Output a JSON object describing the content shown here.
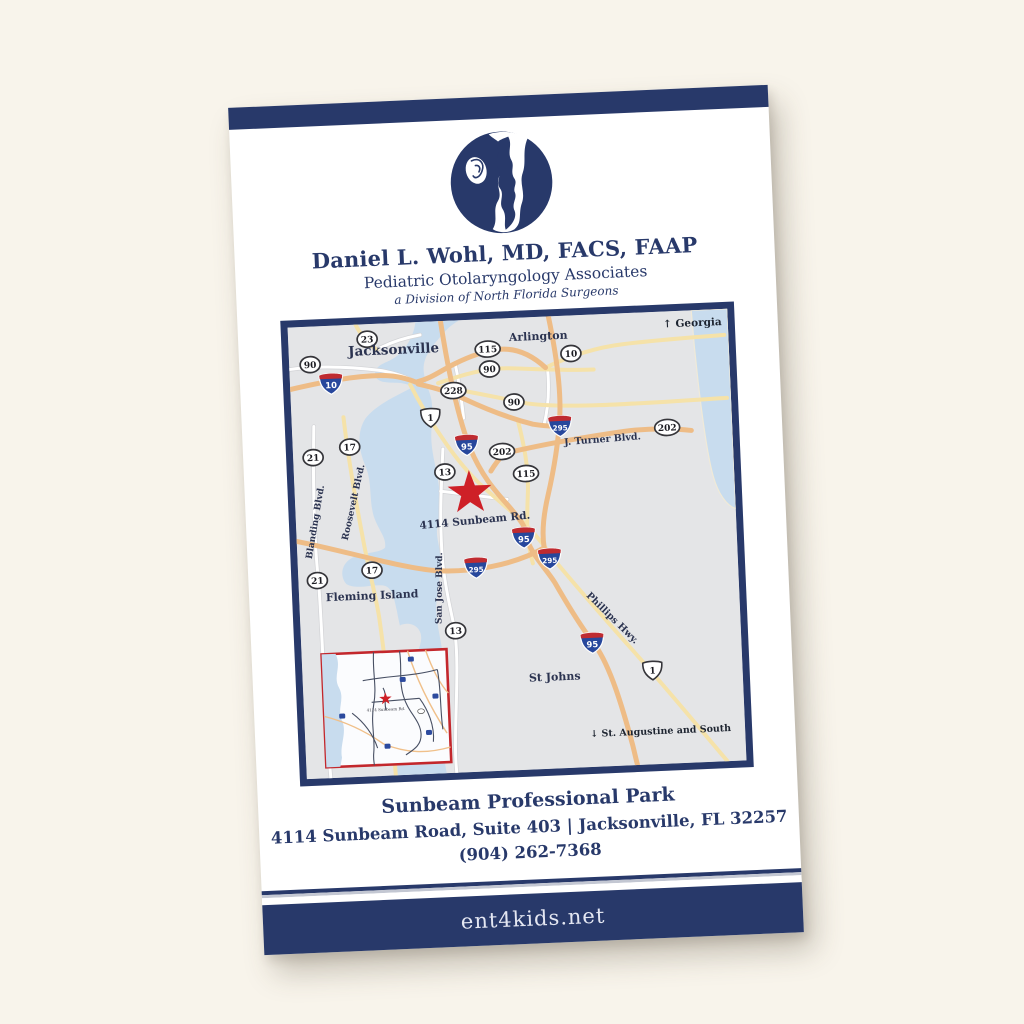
{
  "page": {
    "background": "#f8f4eb"
  },
  "flyer": {
    "navy": "#28396a",
    "practice": {
      "doctor": "Daniel L. Wohl, MD, FACS, FAAP",
      "specialty": "Pediatric Otolaryngology Associates",
      "division": "a Division of North Florida Surgeons"
    },
    "contact": {
      "park": "Sunbeam Professional Park",
      "address": "4114 Sunbeam Road, Suite 403  |  Jacksonville, FL 32257",
      "phone": "(904) 262-7368",
      "website": "ent4kids.net"
    }
  },
  "map": {
    "colors": {
      "land": "#e4e5e7",
      "water": "#c8dcee",
      "road_major": "#eebc86",
      "road_minor": "#f5e2a9",
      "road_local": "#ffffff",
      "border": "#28396a",
      "star": "#ce2027",
      "inset_border": "#c3272c",
      "label": "#2b3350",
      "shield_interstate_blue": "#27479c",
      "shield_interstate_red": "#bf2b31"
    },
    "cities": [
      {
        "name": "Jacksonville",
        "x": 105,
        "y": 31,
        "size": 13.5
      },
      {
        "name": "Arlington",
        "x": 250,
        "y": 23,
        "size": 11
      },
      {
        "name": "Fleming Island",
        "x": 73,
        "y": 275,
        "size": 11
      },
      {
        "name": "St Johns",
        "x": 252,
        "y": 364,
        "size": 11
      }
    ],
    "road_labels": [
      {
        "name": "J. Turner Blvd.",
        "x": 310,
        "y": 128,
        "rotation": -2,
        "size": 9.5
      },
      {
        "name": "Phillips Hwy.",
        "x": 310,
        "y": 306,
        "rotation": 47,
        "size": 9.5
      },
      {
        "name": "Blanding Blvd.",
        "x": 22,
        "y": 196,
        "rotation": -78,
        "size": 9
      },
      {
        "name": "Roosevelt Blvd.",
        "x": 61,
        "y": 178,
        "rotation": -75,
        "size": 9
      },
      {
        "name": "San Jose Blvd.",
        "x": 143,
        "y": 267,
        "rotation": -87,
        "size": 9
      }
    ],
    "shields": {
      "ellipse": [
        {
          "n": "23",
          "x": 79,
          "y": 15
        },
        {
          "n": "90",
          "x": 21,
          "y": 38
        },
        {
          "n": "115",
          "x": 199,
          "y": 30
        },
        {
          "n": "90",
          "x": 200,
          "y": 50
        },
        {
          "n": "10",
          "x": 282,
          "y": 38
        },
        {
          "n": "228",
          "x": 163,
          "y": 70
        },
        {
          "n": "90",
          "x": 223,
          "y": 84
        },
        {
          "n": "202",
          "x": 209,
          "y": 133
        },
        {
          "n": "202",
          "x": 375,
          "y": 116
        },
        {
          "n": "13",
          "x": 151,
          "y": 151
        },
        {
          "n": "115",
          "x": 232,
          "y": 156
        },
        {
          "n": "17",
          "x": 57,
          "y": 122
        },
        {
          "n": "21",
          "x": 20,
          "y": 131
        },
        {
          "n": "17",
          "x": 74,
          "y": 246
        },
        {
          "n": "21",
          "x": 19,
          "y": 254
        },
        {
          "n": "13",
          "x": 155,
          "y": 310
        }
      ],
      "us": [
        {
          "n": "1",
          "x": 139,
          "y": 96
        },
        {
          "n": "1",
          "x": 350,
          "y": 358
        }
      ],
      "interstate": [
        {
          "n": "10",
          "x": 41,
          "y": 58
        },
        {
          "n": "95",
          "x": 174,
          "y": 125
        },
        {
          "n": "295",
          "x": 268,
          "y": 110
        },
        {
          "n": "95",
          "x": 227,
          "y": 220
        },
        {
          "n": "295",
          "x": 178,
          "y": 248
        },
        {
          "n": "295",
          "x": 252,
          "y": 242
        },
        {
          "n": "95",
          "x": 291,
          "y": 328
        }
      ]
    },
    "directions": [
      {
        "label": "Georgia",
        "arrow": "↑",
        "x": 434,
        "y": 16,
        "anchor": "end",
        "size": 10.5
      },
      {
        "label": "St. Augustine and South",
        "arrow": "↓",
        "x": 426,
        "y": 422,
        "anchor": "end",
        "size": 9.5
      }
    ],
    "marker": {
      "x": 175,
      "y": 173,
      "radius": 23,
      "label": "4114 Sunbeam Rd.",
      "label_x": 179,
      "label_y": 204,
      "label_rotation": -3,
      "label_size": 10.5
    },
    "inset": {
      "label": "4114 Sunbeam Rd."
    }
  }
}
